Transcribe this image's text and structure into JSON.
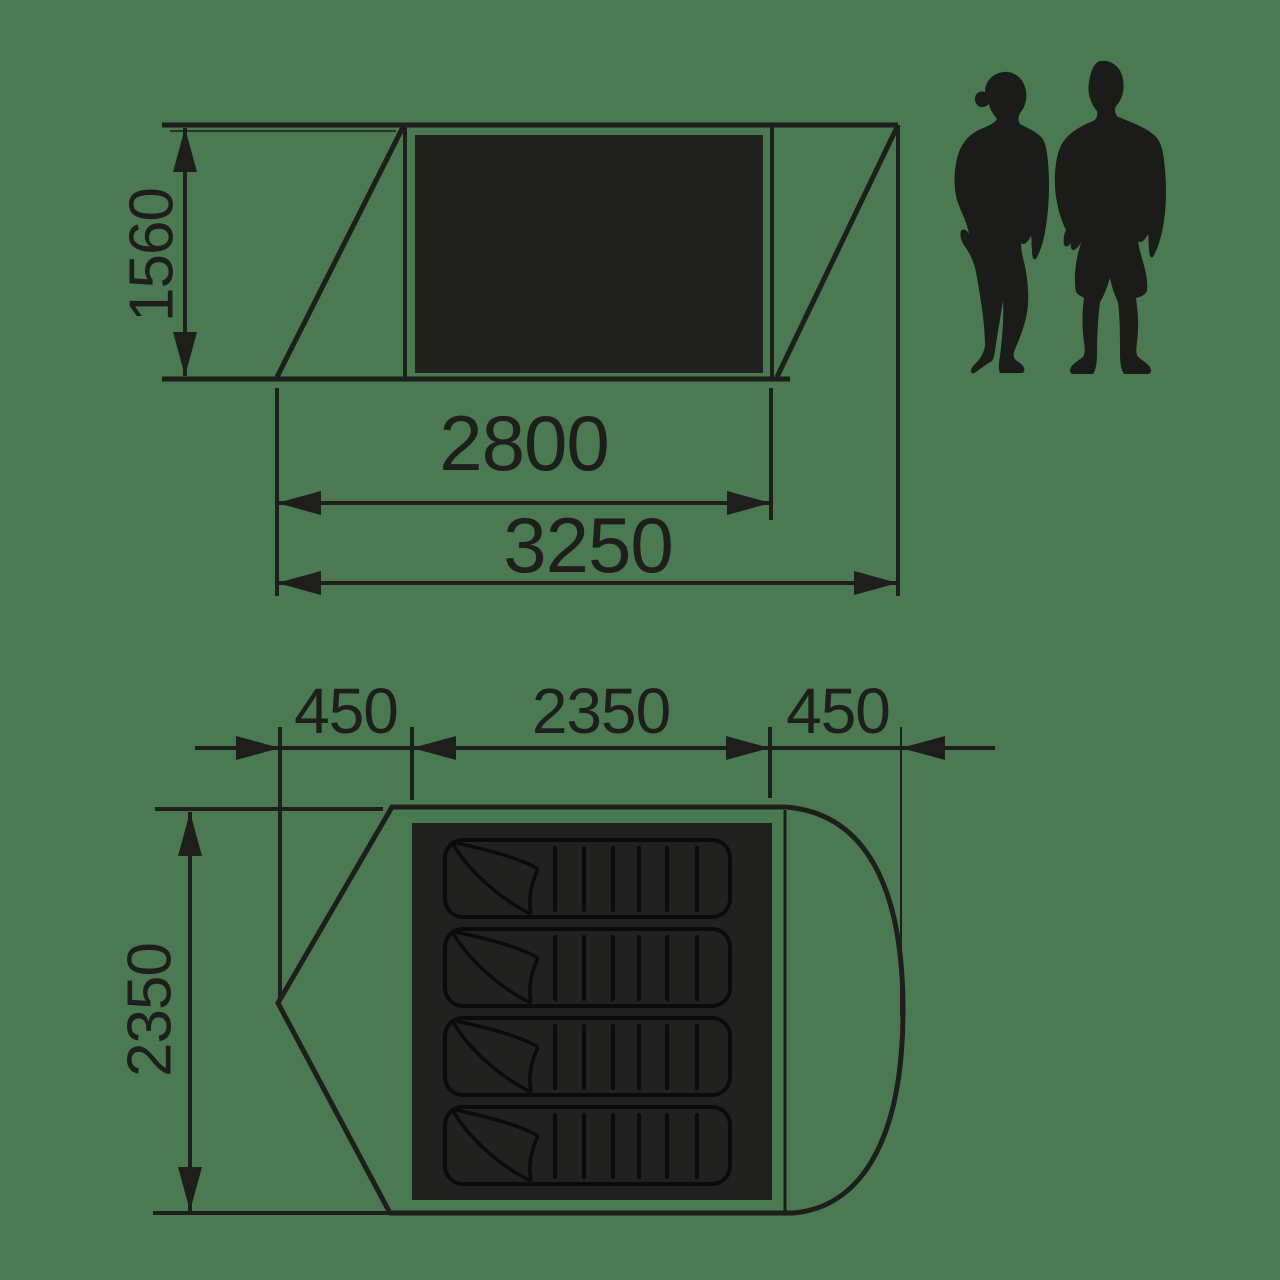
{
  "diagram": {
    "title": "tent-dimensions",
    "colors": {
      "background": "#4B7A52",
      "ink": "#1E1E1C",
      "panel": "#212120"
    },
    "side_view": {
      "height": "1560",
      "inner_width": "2800",
      "outer_width": "3250"
    },
    "floor_plan": {
      "left_porch": "450",
      "inner_width": "2350",
      "right_porch": "450",
      "depth": "2350",
      "sleeping_pad_count": 4
    },
    "figures": {
      "left": "woman-silhouette",
      "right": "man-silhouette"
    }
  }
}
